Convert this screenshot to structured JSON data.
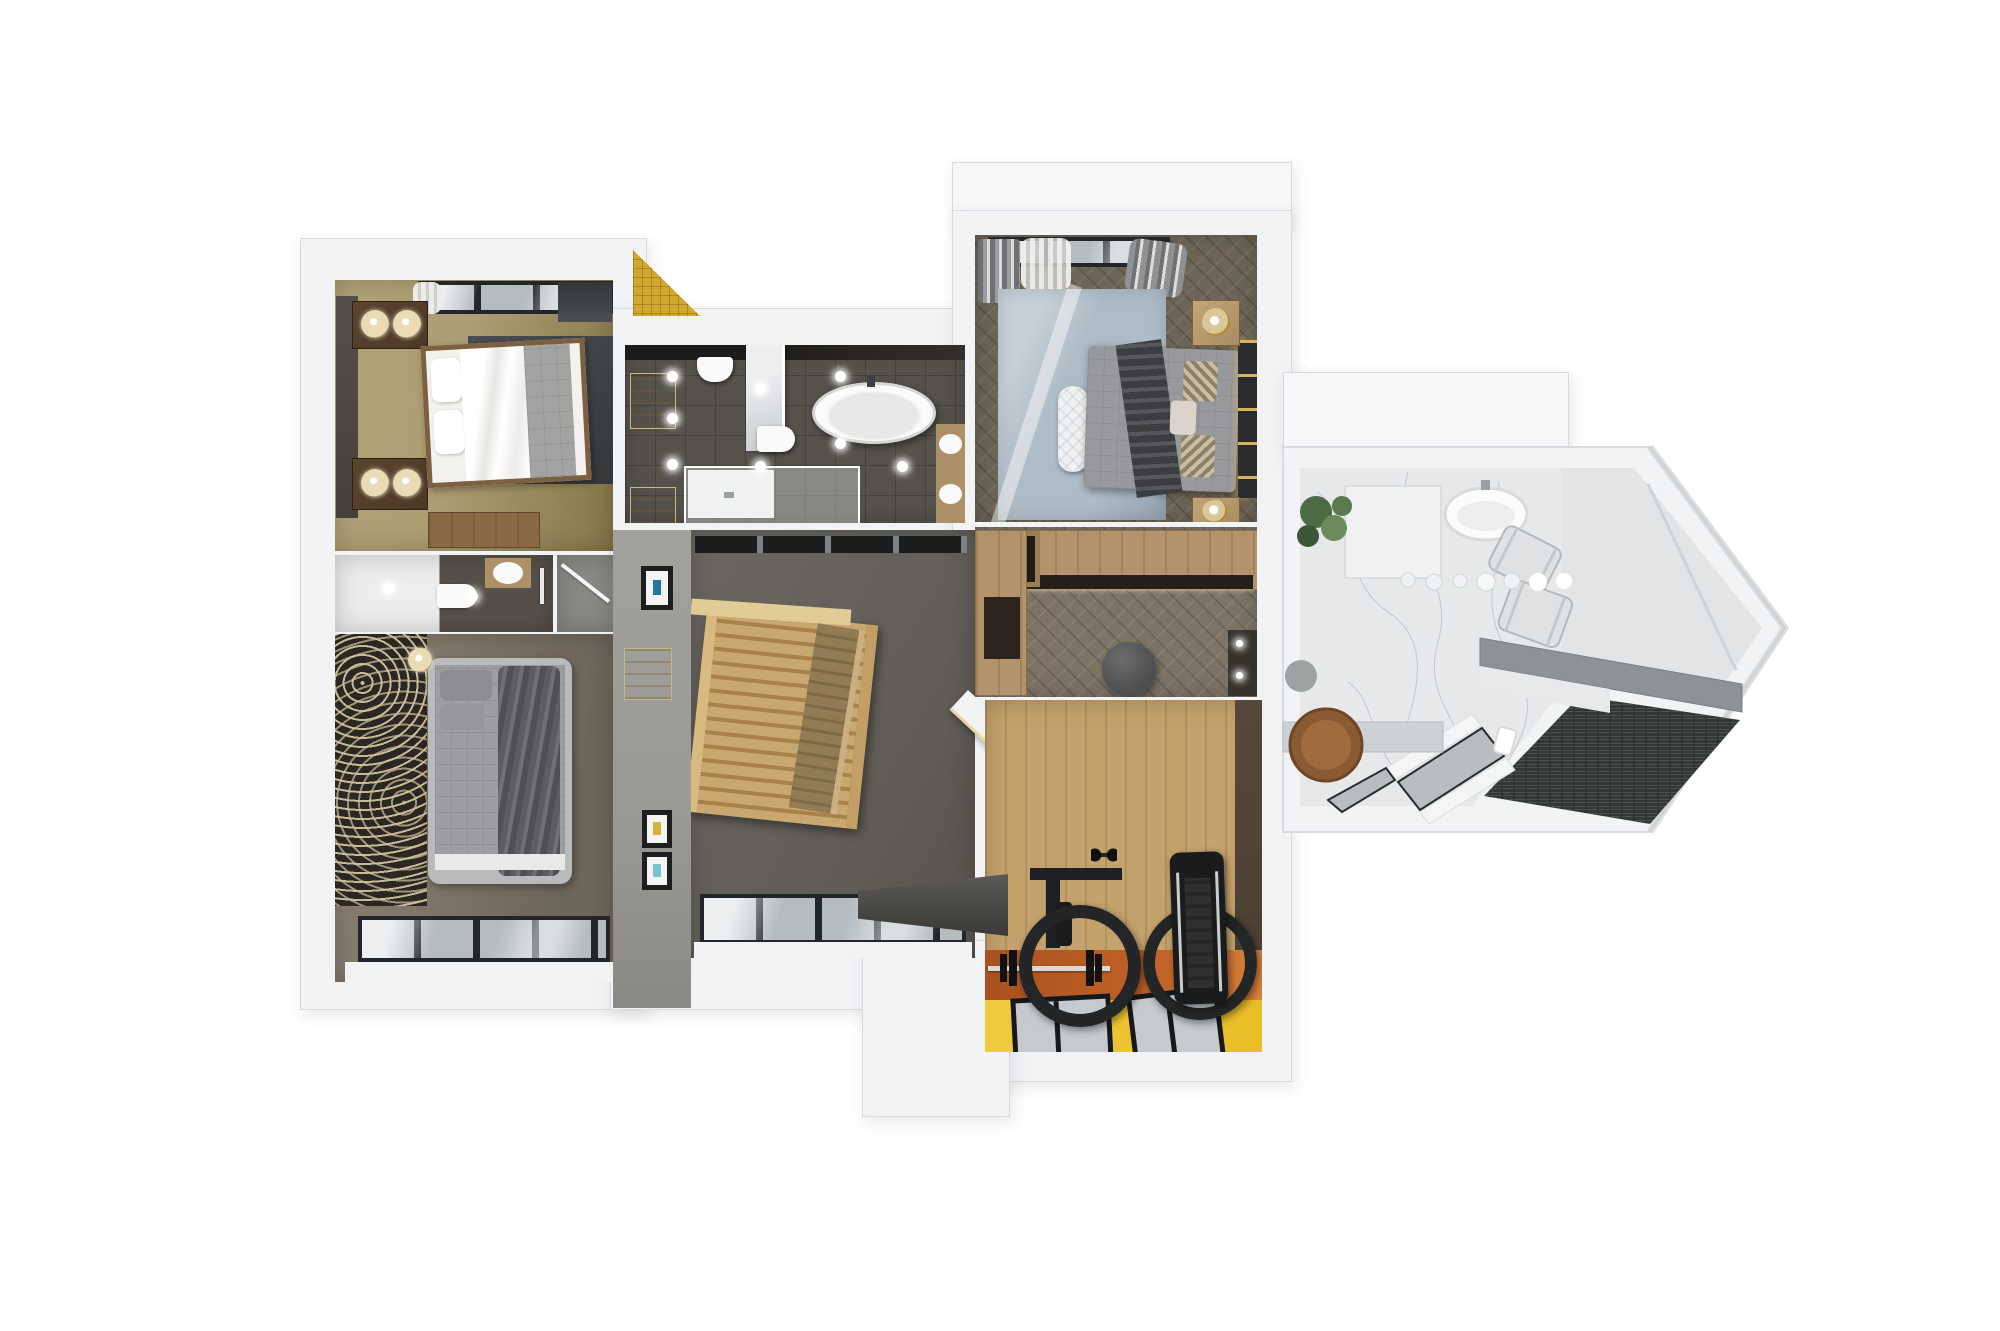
{
  "scene": {
    "description": "Top-down 3D architectural render of an upper-floor apartment plan with two bedrooms, master suite, dressing room, home gym, three bathrooms and a stair landing",
    "background": "#ffffff"
  },
  "palette": {
    "wall-white": "#f2f3f5",
    "wall-edge": "#d8dadd",
    "roof-white": "#f6f7f8",
    "wall-shade": "#c9cccf",
    "shadow": "rgba(60,64,70,.12)",
    "gold-tile": "#d2a72e",
    "gold-tile-dark": "#b98f1f",
    "br2-floor": "#ac9d72",
    "br2-floor-dark": "#857747",
    "br2-rug": "#42454a",
    "wood-dark": "#4c3826",
    "wood-frame": "#7d5f41",
    "lamp-cream": "#e9dcb4",
    "bench-wood": "#8a6a45",
    "panel-dark": "#46403a",
    "window-frame": "#22252a",
    "window-glass": "#b4bcc2",
    "curtain-white": "#ebebe9",
    "curtain-gray": "#8f9193",
    "bath-white-floor": "#eceded",
    "bath-dark-tile": "#57504a",
    "tile-line": "#45423d",
    "fixture-white": "#fafafa",
    "closet-gray": "#8b8985",
    "carpet-dark": "#2c2722",
    "carpet-cream": "#cfc19f",
    "br3-floor": "#8e8475",
    "br3-floor-dark": "#6f665a",
    "br3-bed": "#9c9ea1",
    "br3-bed-frame": "#b9babc",
    "br3-blanket": "#5b5d60",
    "gallery-wall": "#9b9995",
    "niche-cream": "#e7d8a6",
    "frame-black": "#1c1e20",
    "cb-floor": "#55524c",
    "cb-wall-dark": "#322f2a",
    "marble": "#dfe1e4",
    "marble-vein": "#aab0b8",
    "counter-wood": "#ad9166",
    "glass-tint": "rgba(235,240,242,.35)",
    "hall-carpet": "#615e58",
    "stair-wood": "#c9a770",
    "stair-tread": "#a8824a",
    "balustrade-dark": "#1b1d1f",
    "mb-floor": "#6e6557",
    "mb-rug": "#aebcc7",
    "mb-rug-light": "#c6d0d8",
    "mb-bed": "#97999d",
    "mb-throw": "#3b3d3f",
    "pillow-pattern": "#c9bda6",
    "headboard-dark": "#2a2c2e",
    "gold-light": "#d8b35e",
    "nightstand-wood": "#a98d63",
    "bench-white": "#eff1f2",
    "dr-floor": "#7e7466",
    "wardrobe-wood": "#b3926c",
    "wardrobe-gap": "#241f18",
    "pouf-gray": "#4b4d4f",
    "vanity-dark": "#35312b",
    "gym-wood": "#c4a26c",
    "gym-wall-brown": "#473d30",
    "gym-orange": "#c06127",
    "gym-yellow": "#e9bd27",
    "mat-gray": "#c6cacc",
    "mat-frame": "#17181a",
    "equip-black": "#1e2023",
    "bar-silver": "#d8d9da",
    "ab-marble": "#e7e8ea",
    "ab-wall": "#e2e4e6",
    "ab-mosaic": "#343937",
    "ab-counter": "#8e9294",
    "ab-counter-face": "#e8e9ea",
    "plant-green": "#4d6b45",
    "plant-green-light": "#6d8a5d",
    "tray-wood": "#8a5a33",
    "sphere-gray": "#9fa2a3",
    "towel-gray": "#dfe1e3"
  },
  "rooms": [
    {
      "id": "bedroom-2",
      "name": "bedroom (top left)",
      "furniture": [
        "four-poster double bed with white duvet and grey runner",
        "two dark-wood nightstands with twin cream lamps",
        "charcoal area rug",
        "timber storage bench",
        "curtained window wall",
        "gold mosaic exterior accent"
      ]
    },
    {
      "id": "ensuite-bathroom",
      "name": "ensuite bathroom",
      "furniture": [
        "wall-hung toilet",
        "washbasin on timber counter",
        "towel rail",
        "ceiling spots"
      ]
    },
    {
      "id": "hall-closet",
      "name": "closet",
      "furniture": [
        "hinged door"
      ]
    },
    {
      "id": "bedroom-3",
      "name": "bedroom (bottom left)",
      "furniture": [
        "upholstered double bed with grey throw",
        "swirl-patterned carpet",
        "cream table lamps",
        "window wall"
      ]
    },
    {
      "id": "gallery-wall",
      "name": "gallery hallway wall",
      "furniture": [
        "cream display niches",
        "black framed prints"
      ]
    },
    {
      "id": "family-bathroom",
      "name": "family bathroom",
      "furniture": [
        "freestanding oval bathtub",
        "two wall-hung toilets",
        "walk-in glass shower",
        "double washbasin timber vanity",
        "marble partition",
        "ceiling spots"
      ]
    },
    {
      "id": "landing",
      "name": "stair landing",
      "furniture": [
        "timber open staircase",
        "glass balustrade",
        "floor windows",
        "grey carpet"
      ]
    },
    {
      "id": "master-bedroom",
      "name": "master bedroom",
      "furniture": [
        "double bed with dark throw and chevron pillows",
        "white quilted bench",
        "two timber nightstands with brass lamps",
        "backlit slatted headboard",
        "blue-grey rug",
        "grey and sheer curtains",
        "open hanging rail"
      ]
    },
    {
      "id": "dressing-room",
      "name": "walk-in dressing room",
      "furniture": [
        "timber wardrobe run",
        "open shelving cube",
        "round grey pouf",
        "mirror vanity with lights",
        "angled mirror wall"
      ]
    },
    {
      "id": "home-gym",
      "name": "home gym",
      "furniture": [
        "barbell with plates",
        "two large black training wheels",
        "power rack",
        "treadmill",
        "grey rubber mats",
        "orange and yellow sports flooring"
      ]
    },
    {
      "id": "master-bathroom",
      "name": "master bathroom (arrow wing)",
      "furniture": [
        "oval bathtub",
        "marble floor and walls",
        "glass pendant bulbs",
        "quilted towels",
        "floating grey vanity",
        "dark mosaic wet zone",
        "white cabinet",
        "planter",
        "round timber tray",
        "grey sphere stool",
        "white shower partitions"
      ]
    }
  ]
}
